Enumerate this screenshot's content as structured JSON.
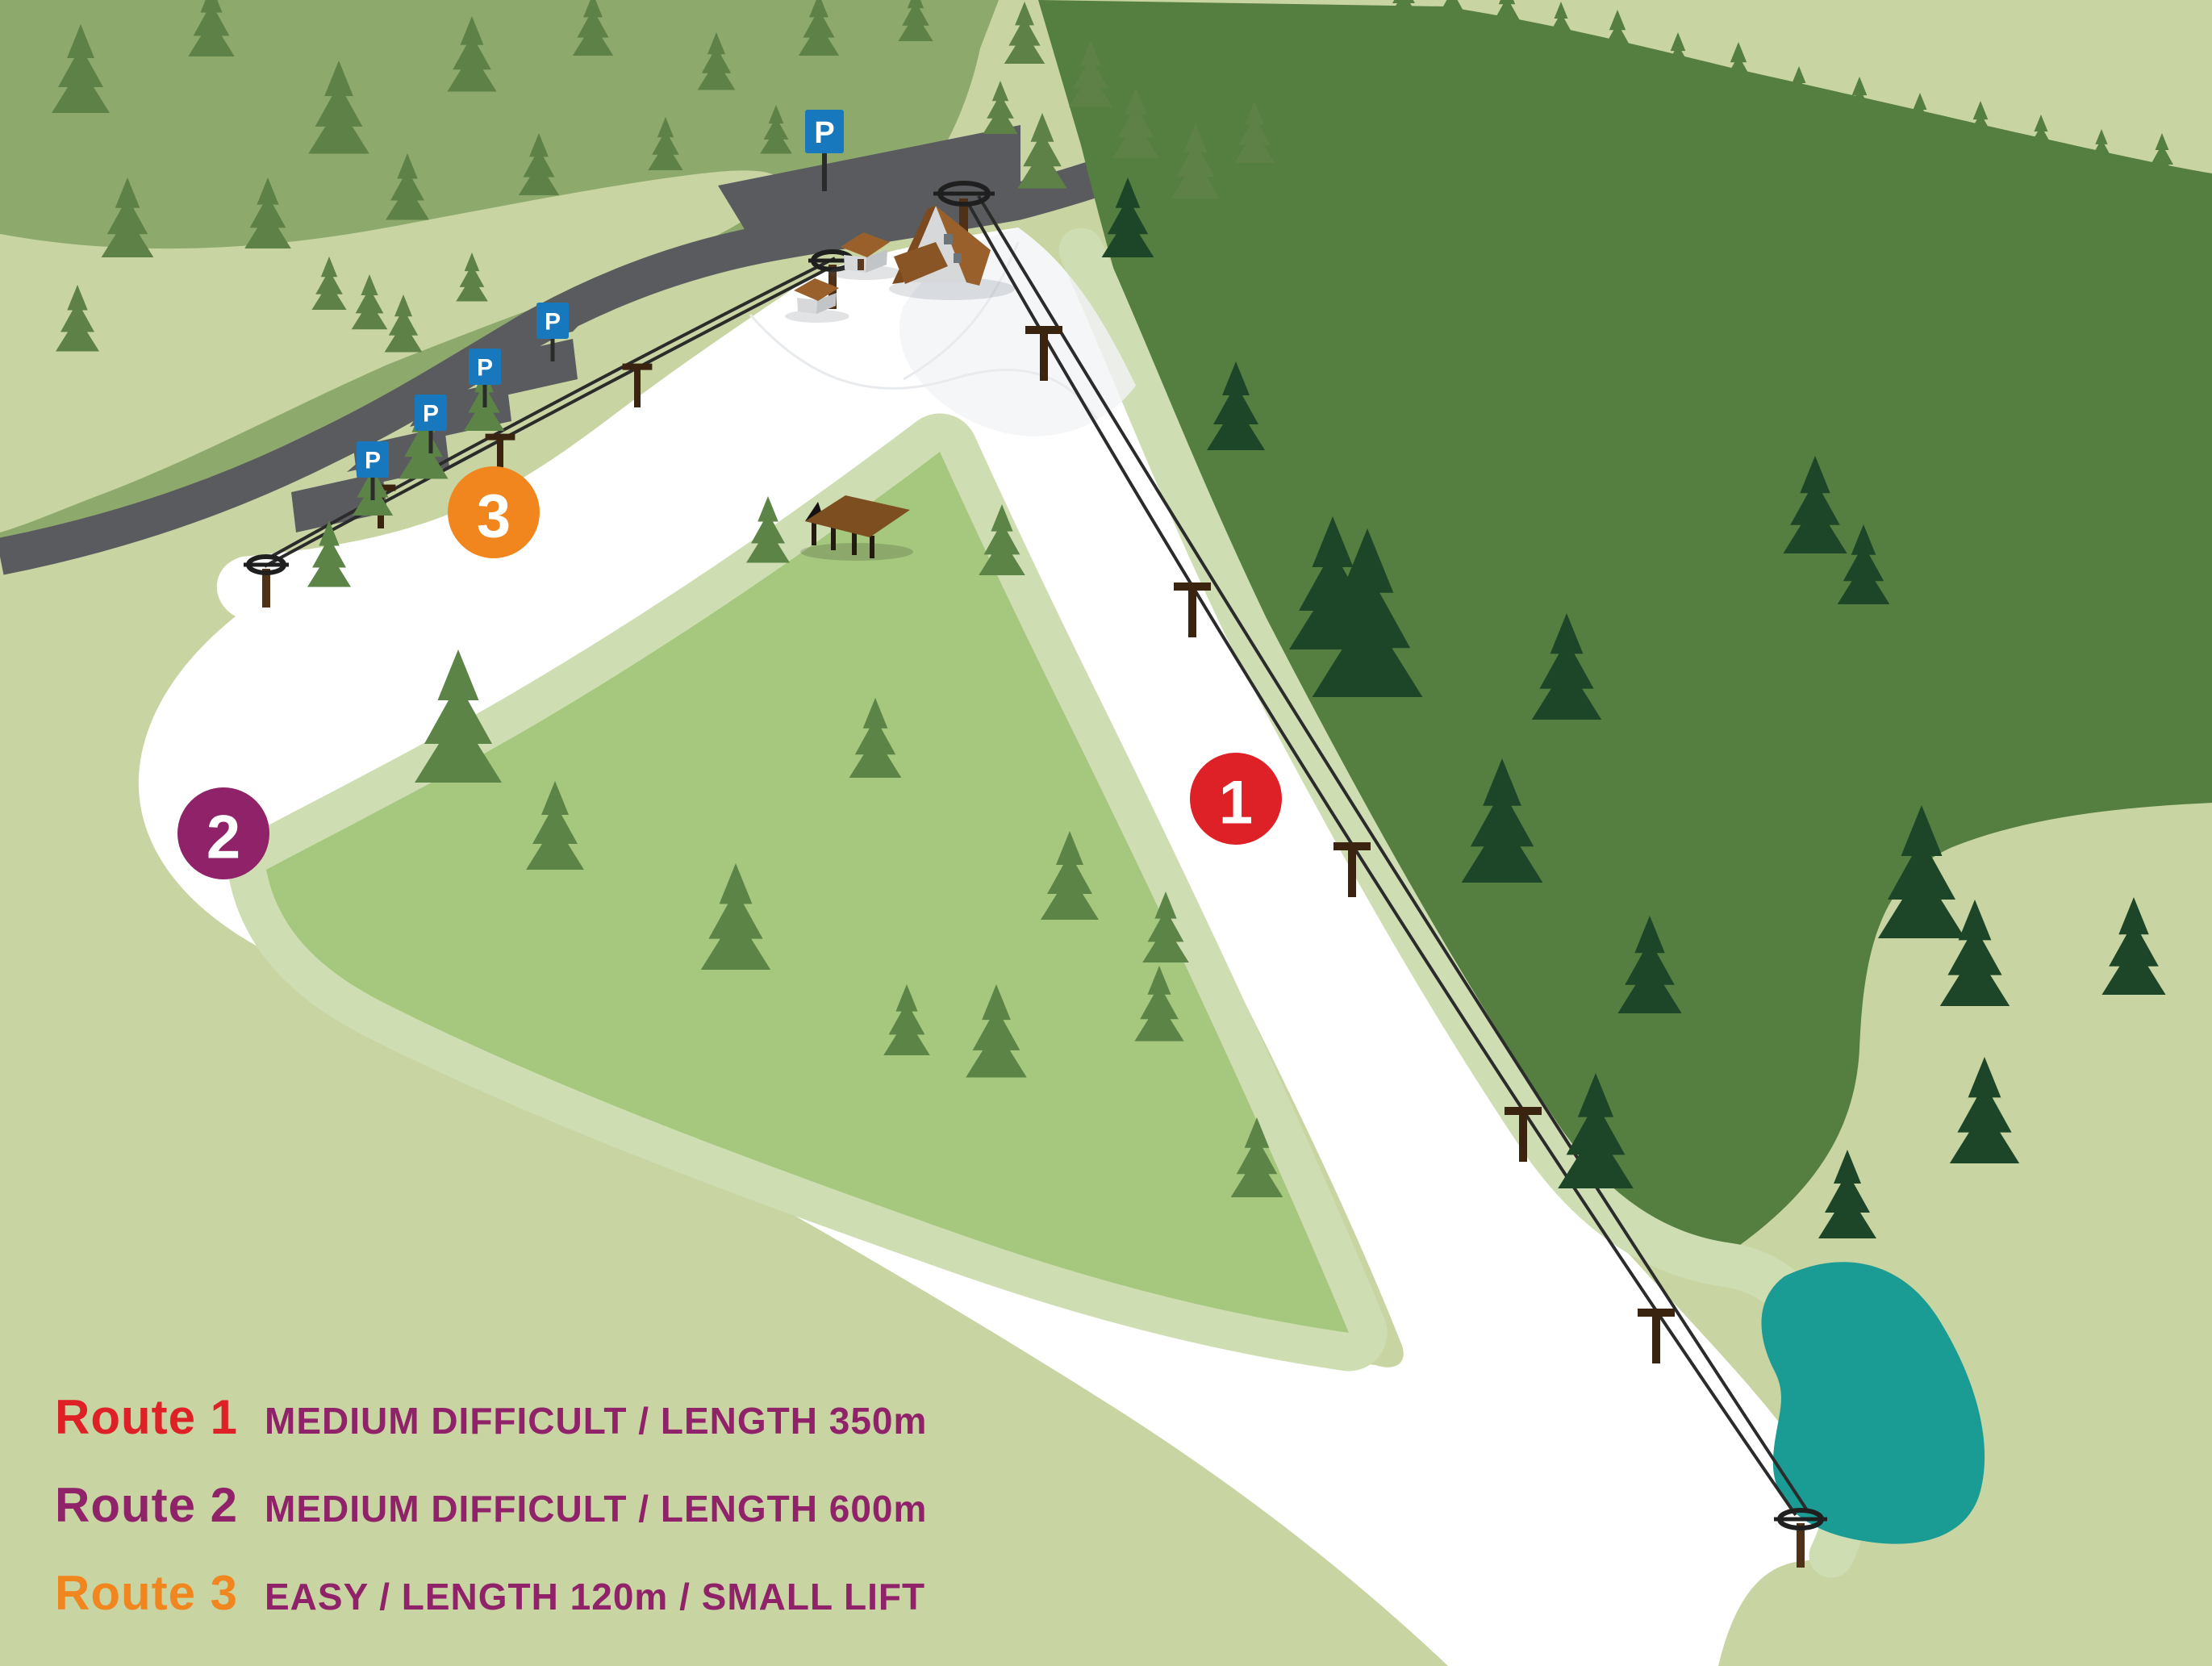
{
  "legend": {
    "rows": [
      {
        "name": "Route 1",
        "details": "MEDIUM DIFFICULT / LENGTH 350m",
        "color": "#DE2126"
      },
      {
        "name": "Route 2",
        "details": "MEDIUM DIFFICULT / LENGTH 600m",
        "color": "#8F2268"
      },
      {
        "name": "Route 3",
        "details": "EASY / LENGTH 120m / SMALL LIFT",
        "color": "#F1861E"
      }
    ],
    "details_color": "#8F2268"
  },
  "markers": {
    "route1": {
      "number": "1",
      "color": "#DE2126"
    },
    "route2": {
      "number": "2",
      "color": "#8F2268"
    },
    "route3": {
      "number": "3",
      "color": "#F1861E"
    }
  },
  "parking": {
    "sign_letter": "P",
    "sign_color": "#1878BE"
  },
  "colors": {
    "background": "#C8D5A3",
    "hill": "#8EA96C",
    "clearing": "#C8D5A3",
    "meadow": "#A5C77E",
    "edge_band": "#CFDDB3",
    "forest": "#557E41",
    "tree_dark": "#1C4627",
    "tree_medium": "#5C8447",
    "tree_sage": "#5E8148",
    "snow": "#FFFFFF",
    "road": "#5A5B5F",
    "pond": "#1A9C94",
    "pole_brown": "#4F3117",
    "roof_brown": "#99602B"
  }
}
